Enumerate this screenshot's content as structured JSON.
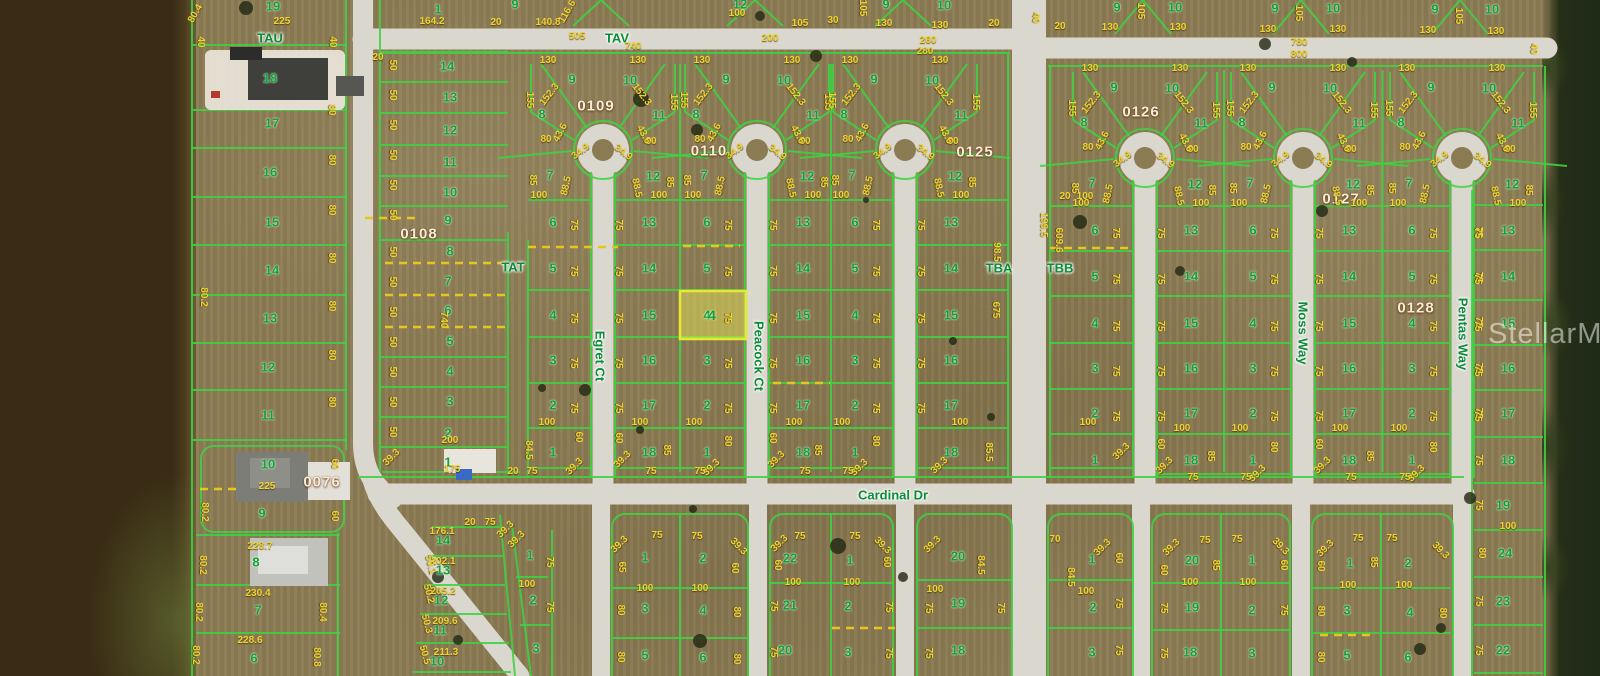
{
  "watermark": "StellarMLS",
  "highlight": {
    "lot": "4"
  },
  "courts": [
    {
      "s": 603,
      "dy": 0,
      "fan_west": [
        "9",
        "8",
        "7"
      ],
      "fan_east": [
        "10",
        "11",
        "12"
      ],
      "col_west": [
        "6",
        "5",
        "4",
        "3",
        "2",
        "1"
      ],
      "col_east": [
        "13",
        "14",
        "15",
        "16",
        "17",
        "18"
      ]
    },
    {
      "s": 757,
      "dy": 0,
      "fan_west": [
        "9",
        "8",
        "7"
      ],
      "fan_east": [
        "10",
        "11",
        "12"
      ],
      "col_west": [
        "6",
        "5",
        "4",
        "3",
        "2",
        "1"
      ],
      "col_east": [
        "13",
        "14",
        "15",
        "16",
        "17",
        "18"
      ]
    },
    {
      "s": 905,
      "dy": 0,
      "fan_west": [
        "9",
        "8",
        "7"
      ],
      "fan_east": [
        "10",
        "11",
        "12"
      ],
      "col_west": [
        "6",
        "5",
        "4",
        "3",
        "2",
        "1"
      ],
      "col_east": [
        "13",
        "14",
        "15",
        "16",
        "17",
        "18"
      ]
    },
    {
      "s": 1145,
      "dy": 8,
      "fan_west": [
        "9",
        "8",
        "7"
      ],
      "fan_east": [
        "10",
        "11",
        "12"
      ],
      "col_west": [
        "6",
        "5",
        "4",
        "3",
        "2",
        "1"
      ],
      "col_east": [
        "13",
        "14",
        "15",
        "16",
        "17",
        "18"
      ]
    },
    {
      "s": 1303,
      "dy": 8,
      "fan_west": [
        "9",
        "8",
        "7"
      ],
      "fan_east": [
        "10",
        "11",
        "12"
      ],
      "col_west": [
        "6",
        "5",
        "4",
        "3",
        "2",
        "1"
      ],
      "col_east": [
        "13",
        "14",
        "15",
        "16",
        "17",
        "18"
      ]
    },
    {
      "s": 1462,
      "dy": 8,
      "fan_west": [
        "9",
        "8",
        "7"
      ],
      "fan_east": [
        "10",
        "11",
        "12"
      ],
      "col_west": [
        "6",
        "5",
        "4",
        "3",
        "2",
        "1"
      ],
      "col_east": [
        "13",
        "14",
        "15",
        "16",
        "17",
        "18"
      ]
    }
  ],
  "fan_dims": [
    "130",
    "152.3",
    "155",
    "80",
    "43.6",
    "34.9",
    "88.5",
    "85",
    "100"
  ],
  "col_dim": "75",
  "pair_dims": [
    "60",
    "39.3",
    "75",
    "85",
    "100",
    "100",
    "80",
    "39.3",
    "75"
  ],
  "labels": [
    [
      419,
      234,
      "0108",
      "B"
    ],
    [
      322,
      482,
      "0076",
      "B"
    ],
    [
      596,
      106,
      "0109",
      "B"
    ],
    [
      709,
      151,
      "0110",
      "B"
    ],
    [
      975,
      152,
      "0125",
      "B"
    ],
    [
      1141,
      112,
      "0126",
      "B"
    ],
    [
      1341,
      199,
      "0127",
      "B"
    ],
    [
      1416,
      308,
      "0128",
      "B"
    ],
    [
      270,
      38,
      "TAU",
      "S"
    ],
    [
      617,
      38,
      "TAV",
      "S"
    ],
    [
      513,
      267,
      "TAT",
      "S"
    ],
    [
      999,
      268,
      "TBA",
      "S"
    ],
    [
      1060,
      268,
      "TBB",
      "S"
    ],
    [
      893,
      495,
      "Cardinal Dr",
      "S"
    ],
    [
      600,
      356,
      "Egret Ct",
      "V"
    ],
    [
      759,
      356,
      "Peacock Ct",
      "V"
    ],
    [
      1303,
      333,
      "Moss Way",
      "V"
    ],
    [
      1463,
      334,
      "Pentas Way",
      "V"
    ],
    [
      273,
      6,
      "19",
      "L"
    ],
    [
      270,
      78,
      "18",
      "L"
    ],
    [
      272,
      123,
      "17",
      "L"
    ],
    [
      270,
      172,
      "16",
      "L"
    ],
    [
      272,
      222,
      "15",
      "L"
    ],
    [
      272,
      270,
      "14",
      "L"
    ],
    [
      270,
      318,
      "13",
      "L"
    ],
    [
      268,
      367,
      "12",
      "L"
    ],
    [
      268,
      415,
      "11",
      "L"
    ],
    [
      268,
      464,
      "10",
      "L"
    ],
    [
      262,
      513,
      "9",
      "L"
    ],
    [
      256,
      562,
      "8",
      "L"
    ],
    [
      258,
      610,
      "7",
      "L"
    ],
    [
      254,
      658,
      "6",
      "L"
    ],
    [
      282,
      22,
      "225",
      "D"
    ],
    [
      196,
      14,
      "80.4",
      "D",
      -60
    ],
    [
      200,
      42,
      "40",
      "D",
      90
    ],
    [
      332,
      42,
      "40",
      "D",
      90
    ],
    [
      331,
      110,
      "80",
      "D",
      90
    ],
    [
      331,
      160,
      "80",
      "D",
      90
    ],
    [
      331,
      210,
      "80",
      "D",
      90
    ],
    [
      331,
      258,
      "80",
      "D",
      90
    ],
    [
      331,
      306,
      "80",
      "D",
      90
    ],
    [
      331,
      355,
      "80",
      "D",
      90
    ],
    [
      331,
      402,
      "80",
      "D",
      90
    ],
    [
      334,
      464,
      "60",
      "D",
      90
    ],
    [
      334,
      516,
      "60",
      "D",
      90
    ],
    [
      203,
      297,
      "80.2",
      "D",
      90
    ],
    [
      204,
      512,
      "80.2",
      "D",
      90
    ],
    [
      202,
      565,
      "80.2",
      "D",
      90
    ],
    [
      198,
      612,
      "80.2",
      "D",
      90
    ],
    [
      195,
      655,
      "80.2",
      "D",
      90
    ],
    [
      267,
      487,
      "225",
      "D"
    ],
    [
      260,
      547,
      "228.7",
      "D"
    ],
    [
      258,
      594,
      "230.4",
      "D"
    ],
    [
      250,
      641,
      "228.6",
      "D"
    ],
    [
      322,
      612,
      "80.4",
      "D",
      90
    ],
    [
      316,
      657,
      "80.8",
      "D",
      90
    ],
    [
      438,
      9,
      "1",
      "L"
    ],
    [
      447,
      66,
      "14",
      "L"
    ],
    [
      450,
      97,
      "13",
      "L"
    ],
    [
      450,
      130,
      "12",
      "L"
    ],
    [
      450,
      162,
      "11",
      "L"
    ],
    [
      450,
      192,
      "10",
      "L"
    ],
    [
      448,
      220,
      "9",
      "L"
    ],
    [
      450,
      251,
      "8",
      "L"
    ],
    [
      448,
      281,
      "7",
      "L"
    ],
    [
      448,
      310,
      "6",
      "L"
    ],
    [
      450,
      341,
      "5",
      "L"
    ],
    [
      450,
      371,
      "4",
      "L"
    ],
    [
      450,
      401,
      "3",
      "L"
    ],
    [
      448,
      433,
      "2",
      "L"
    ],
    [
      448,
      462,
      "1",
      "L"
    ],
    [
      432,
      22,
      "164.2",
      "D"
    ],
    [
      450,
      441,
      "200",
      "D"
    ],
    [
      452,
      470,
      "175",
      "D"
    ],
    [
      443,
      320,
      "740",
      "D",
      90
    ],
    [
      392,
      458,
      "39.3",
      "D",
      -45
    ],
    [
      392,
      65,
      "50",
      "D",
      90
    ],
    [
      392,
      95,
      "50",
      "D",
      90
    ],
    [
      392,
      125,
      "50",
      "D",
      90
    ],
    [
      392,
      155,
      "50",
      "D",
      90
    ],
    [
      392,
      185,
      "50",
      "D",
      90
    ],
    [
      392,
      215,
      "50",
      "D",
      90
    ],
    [
      392,
      252,
      "50",
      "D",
      90
    ],
    [
      392,
      282,
      "50",
      "D",
      90
    ],
    [
      392,
      312,
      "50",
      "D",
      90
    ],
    [
      392,
      342,
      "50",
      "D",
      90
    ],
    [
      392,
      372,
      "50",
      "D",
      90
    ],
    [
      392,
      402,
      "50",
      "D",
      90
    ],
    [
      392,
      432,
      "50",
      "D",
      90
    ],
    [
      547,
      423,
      "100",
      "D"
    ],
    [
      528,
      450,
      "84.5",
      "D",
      90
    ],
    [
      575,
      467,
      "39.3",
      "D",
      -45
    ],
    [
      532,
      472,
      "75",
      "D"
    ],
    [
      513,
      472,
      "20",
      "D"
    ],
    [
      578,
      437,
      "60",
      "D",
      90
    ],
    [
      496,
      23,
      "20",
      "D"
    ],
    [
      548,
      23,
      "140.8",
      "D"
    ],
    [
      568,
      12,
      "116.6",
      "D",
      -60
    ],
    [
      515,
      4,
      "9",
      "L"
    ],
    [
      577,
      37,
      "505",
      "D"
    ],
    [
      633,
      47,
      "740",
      "D"
    ],
    [
      740,
      4,
      "12",
      "L"
    ],
    [
      737,
      14,
      "100",
      "D"
    ],
    [
      800,
      24,
      "105",
      "D"
    ],
    [
      833,
      21,
      "30",
      "D"
    ],
    [
      886,
      4,
      "9",
      "L"
    ],
    [
      884,
      24,
      "130",
      "D"
    ],
    [
      862,
      8,
      "105",
      "D",
      90
    ],
    [
      944,
      5,
      "10",
      "L"
    ],
    [
      940,
      26,
      "130",
      "D"
    ],
    [
      994,
      24,
      "20",
      "D"
    ],
    [
      770,
      39,
      "200",
      "D"
    ],
    [
      928,
      41,
      "260",
      "D"
    ],
    [
      925,
      52,
      "280",
      "D"
    ],
    [
      1035,
      18,
      "40",
      "D",
      90
    ],
    [
      1117,
      7,
      "9",
      "L"
    ],
    [
      1175,
      7,
      "10",
      "L"
    ],
    [
      1140,
      11,
      "105",
      "D",
      90
    ],
    [
      1110,
      28,
      "130",
      "D"
    ],
    [
      1178,
      28,
      "130",
      "D"
    ],
    [
      1060,
      27,
      "20",
      "D"
    ],
    [
      1275,
      8,
      "9",
      "L"
    ],
    [
      1333,
      8,
      "10",
      "L"
    ],
    [
      1298,
      13,
      "105",
      "D",
      90
    ],
    [
      1268,
      30,
      "130",
      "D"
    ],
    [
      1338,
      30,
      "130",
      "D"
    ],
    [
      1435,
      9,
      "9",
      "L"
    ],
    [
      1492,
      9,
      "10",
      "L"
    ],
    [
      1458,
      16,
      "105",
      "D",
      90
    ],
    [
      1428,
      31,
      "130",
      "D"
    ],
    [
      1496,
      32,
      "130",
      "D"
    ],
    [
      1533,
      49,
      "40",
      "D",
      90
    ],
    [
      1299,
      43,
      "780",
      "D"
    ],
    [
      1299,
      55,
      "800",
      "D"
    ],
    [
      378,
      58,
      "20",
      "D"
    ],
    [
      1065,
      197,
      "20",
      "D"
    ],
    [
      996,
      252,
      "98.5",
      "D",
      90
    ],
    [
      995,
      310,
      "675",
      "D",
      90
    ],
    [
      960,
      423,
      "100",
      "D"
    ],
    [
      988,
      452,
      "85.5",
      "D",
      90
    ],
    [
      940,
      466,
      "39.3",
      "D",
      -45
    ],
    [
      1085,
      197,
      "100",
      "D"
    ],
    [
      1043,
      225,
      "199.5",
      "D",
      90
    ],
    [
      1058,
      240,
      "609.6",
      "D",
      90
    ],
    [
      1088,
      423,
      "100",
      "D"
    ],
    [
      1122,
      452,
      "39.3",
      "D",
      -45
    ],
    [
      443,
      540,
      "14",
      "L"
    ],
    [
      443,
      570,
      "13",
      "L"
    ],
    [
      441,
      600,
      "12",
      "L"
    ],
    [
      440,
      630,
      "11",
      "L"
    ],
    [
      437,
      661,
      "10",
      "L"
    ],
    [
      442,
      532,
      "176.1",
      "D"
    ],
    [
      443,
      562,
      "202.1",
      "D"
    ],
    [
      443,
      592,
      "205.2",
      "D"
    ],
    [
      445,
      622,
      "209.6",
      "D"
    ],
    [
      446,
      653,
      "211.3",
      "D"
    ],
    [
      430,
      565,
      "50.1",
      "D",
      75
    ],
    [
      428,
      594,
      "50.2",
      "D",
      75
    ],
    [
      426,
      624,
      "50.3",
      "D",
      75
    ],
    [
      424,
      655,
      "50.5",
      "D",
      75
    ],
    [
      470,
      523,
      "20",
      "D"
    ],
    [
      490,
      523,
      "75",
      "D"
    ],
    [
      506,
      530,
      "39.3",
      "D",
      -45
    ],
    [
      530,
      555,
      "1",
      "L"
    ],
    [
      533,
      600,
      "2",
      "L"
    ],
    [
      536,
      648,
      "3",
      "L"
    ],
    [
      527,
      585,
      "100",
      "D"
    ],
    [
      517,
      540,
      "39.3",
      "D",
      -45
    ],
    [
      549,
      562,
      "75",
      "D",
      90
    ],
    [
      549,
      607,
      "75",
      "D",
      90
    ],
    [
      645,
      557,
      "1",
      "L"
    ],
    [
      703,
      558,
      "2",
      "L"
    ],
    [
      645,
      608,
      "3",
      "L"
    ],
    [
      703,
      610,
      "4",
      "L"
    ],
    [
      645,
      655,
      "5",
      "L"
    ],
    [
      703,
      657,
      "6",
      "L"
    ],
    [
      620,
      545,
      "39.3",
      "D",
      -45
    ],
    [
      738,
      547,
      "39.3",
      "D",
      45
    ],
    [
      657,
      536,
      "75",
      "D"
    ],
    [
      697,
      537,
      "75",
      "D"
    ],
    [
      621,
      567,
      "65",
      "D",
      90
    ],
    [
      734,
      568,
      "60",
      "D",
      90
    ],
    [
      645,
      589,
      "100",
      "D"
    ],
    [
      700,
      589,
      "100",
      "D"
    ],
    [
      620,
      610,
      "80",
      "D",
      90
    ],
    [
      736,
      612,
      "80",
      "D",
      90
    ],
    [
      620,
      657,
      "80",
      "D",
      90
    ],
    [
      736,
      659,
      "80",
      "D",
      90
    ],
    [
      790,
      558,
      "22",
      "L"
    ],
    [
      850,
      560,
      "1",
      "L"
    ],
    [
      790,
      605,
      "21",
      "L"
    ],
    [
      848,
      606,
      "2",
      "L"
    ],
    [
      785,
      650,
      "20",
      "L"
    ],
    [
      848,
      652,
      "3",
      "L"
    ],
    [
      780,
      544,
      "39.3",
      "D",
      -45
    ],
    [
      882,
      546,
      "39.3",
      "D",
      45
    ],
    [
      800,
      537,
      "75",
      "D"
    ],
    [
      855,
      537,
      "75",
      "D"
    ],
    [
      777,
      565,
      "60",
      "D",
      90
    ],
    [
      886,
      562,
      "60",
      "D",
      90
    ],
    [
      793,
      583,
      "100",
      "D"
    ],
    [
      852,
      583,
      "100",
      "D"
    ],
    [
      773,
      606,
      "75",
      "D",
      90
    ],
    [
      888,
      607,
      "75",
      "D",
      90
    ],
    [
      773,
      652,
      "75",
      "D",
      90
    ],
    [
      888,
      653,
      "75",
      "D",
      90
    ],
    [
      958,
      556,
      "20",
      "L"
    ],
    [
      958,
      603,
      "19",
      "L"
    ],
    [
      958,
      650,
      "18",
      "L"
    ],
    [
      980,
      565,
      "84.5",
      "D",
      90
    ],
    [
      935,
      590,
      "100",
      "D"
    ],
    [
      933,
      545,
      "39.3",
      "D",
      -45
    ],
    [
      1000,
      608,
      "75",
      "D",
      90
    ],
    [
      928,
      608,
      "75",
      "D",
      90
    ],
    [
      928,
      653,
      "75",
      "D",
      90
    ],
    [
      1092,
      559,
      "1",
      "L"
    ],
    [
      1093,
      607,
      "2",
      "L"
    ],
    [
      1092,
      652,
      "3",
      "L"
    ],
    [
      1055,
      540,
      "70",
      "D"
    ],
    [
      1103,
      548,
      "39.3",
      "D",
      -45
    ],
    [
      1070,
      577,
      "84.5",
      "D",
      90
    ],
    [
      1086,
      592,
      "100",
      "D"
    ],
    [
      1118,
      603,
      "75",
      "D",
      90
    ],
    [
      1118,
      558,
      "60",
      "D",
      90
    ],
    [
      1118,
      650,
      "75",
      "D",
      90
    ],
    [
      1192,
      560,
      "20",
      "L"
    ],
    [
      1252,
      560,
      "1",
      "L"
    ],
    [
      1192,
      607,
      "19",
      "L"
    ],
    [
      1252,
      610,
      "2",
      "L"
    ],
    [
      1190,
      652,
      "18",
      "L"
    ],
    [
      1252,
      653,
      "3",
      "L"
    ],
    [
      1172,
      548,
      "39.3",
      "D",
      -45
    ],
    [
      1280,
      547,
      "39.3",
      "D",
      45
    ],
    [
      1205,
      541,
      "75",
      "D"
    ],
    [
      1237,
      540,
      "75",
      "D"
    ],
    [
      1215,
      565,
      "85",
      "D",
      90
    ],
    [
      1163,
      570,
      "60",
      "D",
      90
    ],
    [
      1283,
      565,
      "60",
      "D",
      90
    ],
    [
      1190,
      583,
      "100",
      "D"
    ],
    [
      1248,
      583,
      "100",
      "D"
    ],
    [
      1163,
      608,
      "75",
      "D",
      90
    ],
    [
      1283,
      610,
      "75",
      "D",
      90
    ],
    [
      1163,
      653,
      "75",
      "D",
      90
    ],
    [
      1350,
      563,
      "1",
      "L"
    ],
    [
      1408,
      563,
      "2",
      "L"
    ],
    [
      1347,
      610,
      "3",
      "L"
    ],
    [
      1410,
      612,
      "4",
      "L"
    ],
    [
      1347,
      655,
      "5",
      "L"
    ],
    [
      1408,
      657,
      "6",
      "L"
    ],
    [
      1326,
      549,
      "39.3",
      "D",
      -45
    ],
    [
      1440,
      551,
      "39.3",
      "D",
      45
    ],
    [
      1358,
      539,
      "75",
      "D"
    ],
    [
      1392,
      539,
      "75",
      "D"
    ],
    [
      1373,
      562,
      "85",
      "D",
      90
    ],
    [
      1320,
      566,
      "60",
      "D",
      90
    ],
    [
      1348,
      586,
      "100",
      "D"
    ],
    [
      1404,
      586,
      "100",
      "D"
    ],
    [
      1320,
      611,
      "80",
      "D",
      90
    ],
    [
      1442,
      613,
      "80",
      "D",
      90
    ],
    [
      1320,
      657,
      "80",
      "D",
      90
    ],
    [
      1503,
      505,
      "19",
      "L"
    ],
    [
      1505,
      553,
      "24",
      "L"
    ],
    [
      1503,
      601,
      "23",
      "L"
    ],
    [
      1503,
      650,
      "22",
      "L"
    ],
    [
      1508,
      527,
      "100",
      "D"
    ],
    [
      1481,
      553,
      "80",
      "D",
      90
    ],
    [
      1478,
      232,
      "75",
      "D",
      90
    ],
    [
      1478,
      277,
      "75",
      "D",
      90
    ],
    [
      1478,
      322,
      "75",
      "D",
      90
    ],
    [
      1478,
      368,
      "75",
      "D",
      90
    ],
    [
      1478,
      413,
      "75",
      "D",
      90
    ],
    [
      1478,
      460,
      "75",
      "D",
      90
    ],
    [
      1478,
      505,
      "75",
      "D",
      90
    ],
    [
      1478,
      601,
      "75",
      "D",
      90
    ],
    [
      1478,
      650,
      "75",
      "D",
      90
    ]
  ]
}
